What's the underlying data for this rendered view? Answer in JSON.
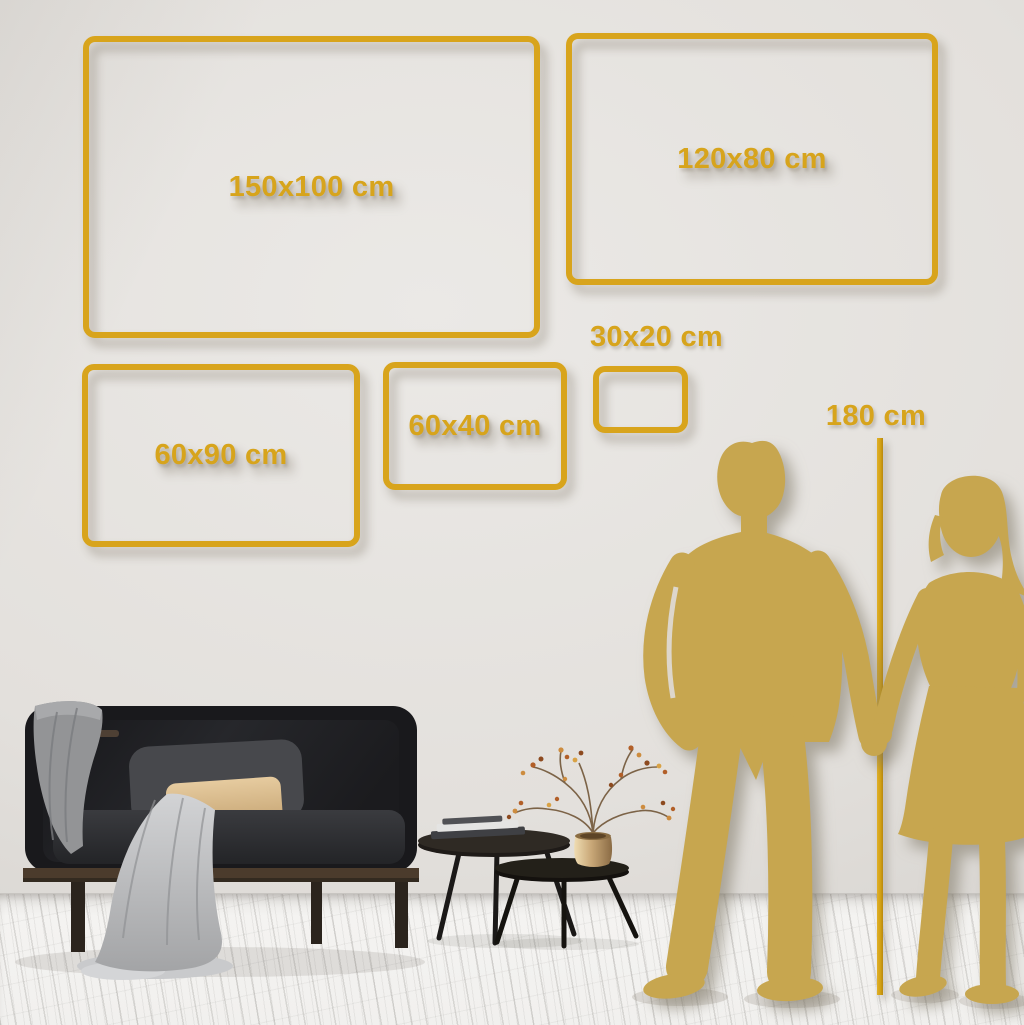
{
  "size_frames": [
    {
      "label": "150x100 cm"
    },
    {
      "label": "120x80 cm"
    },
    {
      "label": "60x90 cm"
    },
    {
      "label": "60x40 cm"
    },
    {
      "label": "30x20 cm"
    }
  ],
  "height_reference": {
    "label": "180 cm"
  },
  "scene_objects": [
    "dark velvet sofa with wood frame",
    "gray blanket draped over sofa",
    "gray and tan pillows",
    "two nesting coffee tables with books",
    "brass vase with dried berry branches",
    "gold couple silhouette holding hands",
    "vertical height measuring line"
  ],
  "colors": {
    "frame_gold": "#D8A41C",
    "label_gold": "#D7A41C",
    "silhouette_gold": "#C7A64F",
    "measure_line": "#D2A012",
    "wall": "#E2DFDB",
    "floor": "#F2F1EE",
    "sofa": "#1A1A1D",
    "pillow_tan": "#D9B98C",
    "blanket": "#B9BABC",
    "wood_rail": "#4B3B2C",
    "brass_vase": "#C9A878"
  }
}
